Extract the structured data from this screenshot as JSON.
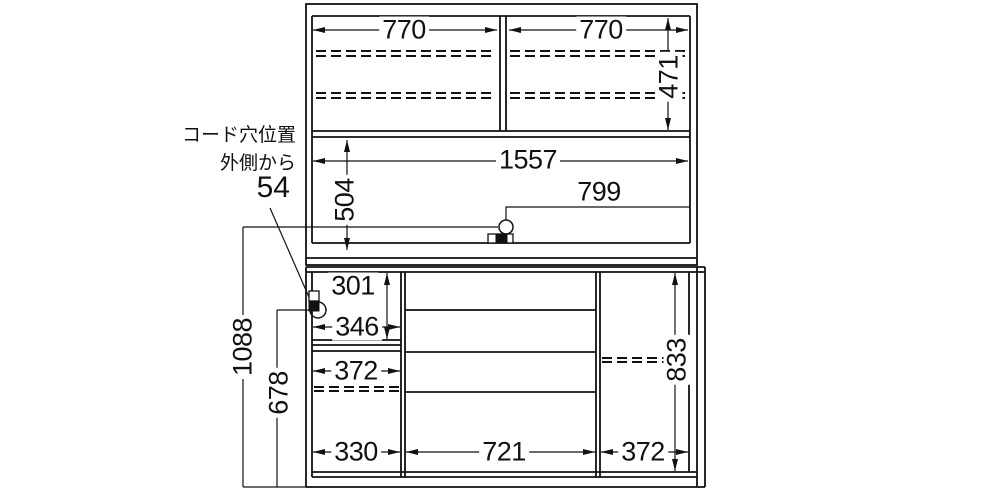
{
  "drawing_type": "furniture-dimension-diagram",
  "colors": {
    "line": "#111111",
    "background": "#ffffff"
  },
  "annotation": {
    "line1": "コード穴位置",
    "line2": "外側から",
    "value": "54"
  },
  "dims": {
    "upper_left_width": "770",
    "upper_right_width": "770",
    "upper_door_height": "471",
    "upper_inner_width": "1557",
    "upper_open_height": "504",
    "cord_hole_from_side": "799",
    "niche_height": "301",
    "niche_width": "346",
    "left_inner_width": "372",
    "left_bottom_width": "330",
    "drawer_width": "721",
    "right_inner_width": "372",
    "right_inner_height": "833",
    "cord_hole_height_total": "1088",
    "cord_hole_height_lower": "678"
  }
}
